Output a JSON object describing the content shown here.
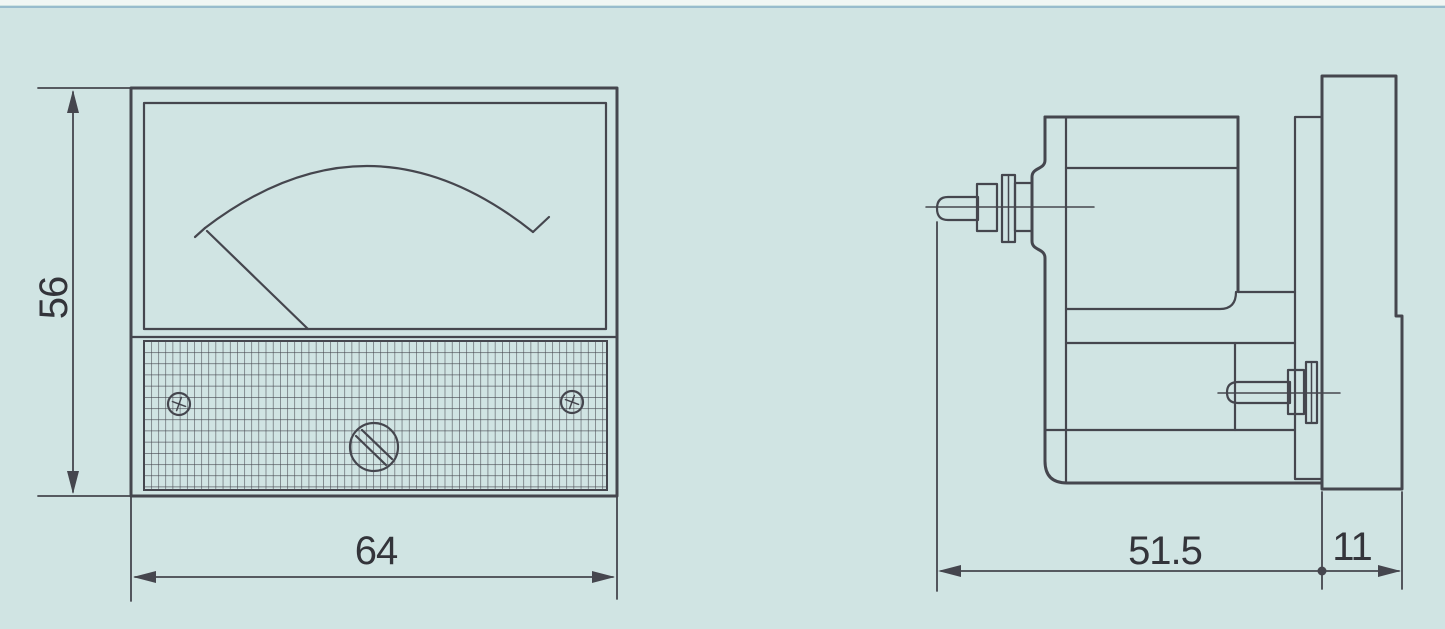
{
  "colors": {
    "background": "#d0e4e3",
    "line": "#45464e",
    "text": "#33343a",
    "scan_edge_band": "#f0f6f4",
    "scan_edge_line": "#85aec6"
  },
  "front_view": {
    "height_dim": "56",
    "width_dim": "64"
  },
  "side_view": {
    "body_depth_dim": "51.5",
    "bezel_depth_dim": "11"
  }
}
